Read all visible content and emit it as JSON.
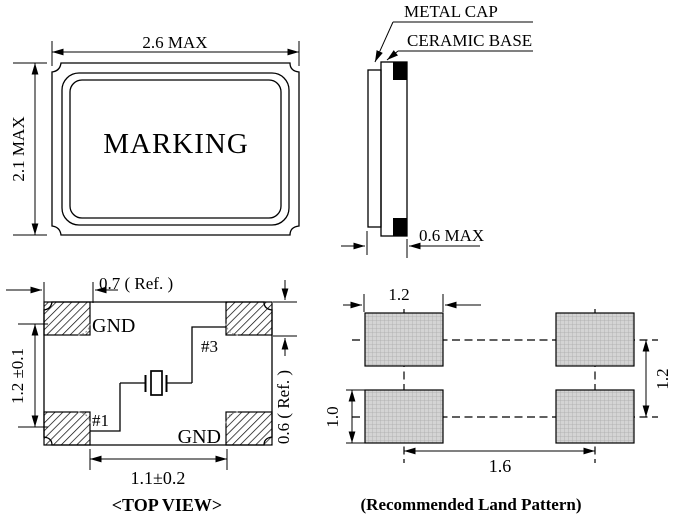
{
  "front_view": {
    "width_dim": "2.6 MAX",
    "height_dim": "2.1 MAX",
    "marking_text": "MARKING"
  },
  "side_view": {
    "metal_cap_label": "METAL CAP",
    "ceramic_base_label": "CERAMIC BASE",
    "thickness_dim": "0.6 MAX"
  },
  "top_view": {
    "title": "<TOP VIEW>",
    "corner_offset_dim": "0.7 ( Ref. )",
    "vertical_pitch_dim": "1.2 ±0.1",
    "pad_height_dim": "0.6 ( Ref. )",
    "horizontal_gap_dim": "1.1±0.2",
    "gnd_label_top": "GND",
    "gnd_label_bottom": "GND",
    "pin1_label": "#1",
    "pin3_label": "#3"
  },
  "land_pattern": {
    "title": "(Recommended Land Pattern)",
    "pad_width_dim": "1.2",
    "pad_height_dim": "1.0",
    "row_pitch_dim": "1.2",
    "column_pitch_dim": "1.6"
  },
  "colors": {
    "line": "#000000",
    "background": "#ffffff",
    "land_pad_fill": "#d4d4d4",
    "land_pad_grid": "#ababab",
    "terminal_black": "#000000"
  }
}
